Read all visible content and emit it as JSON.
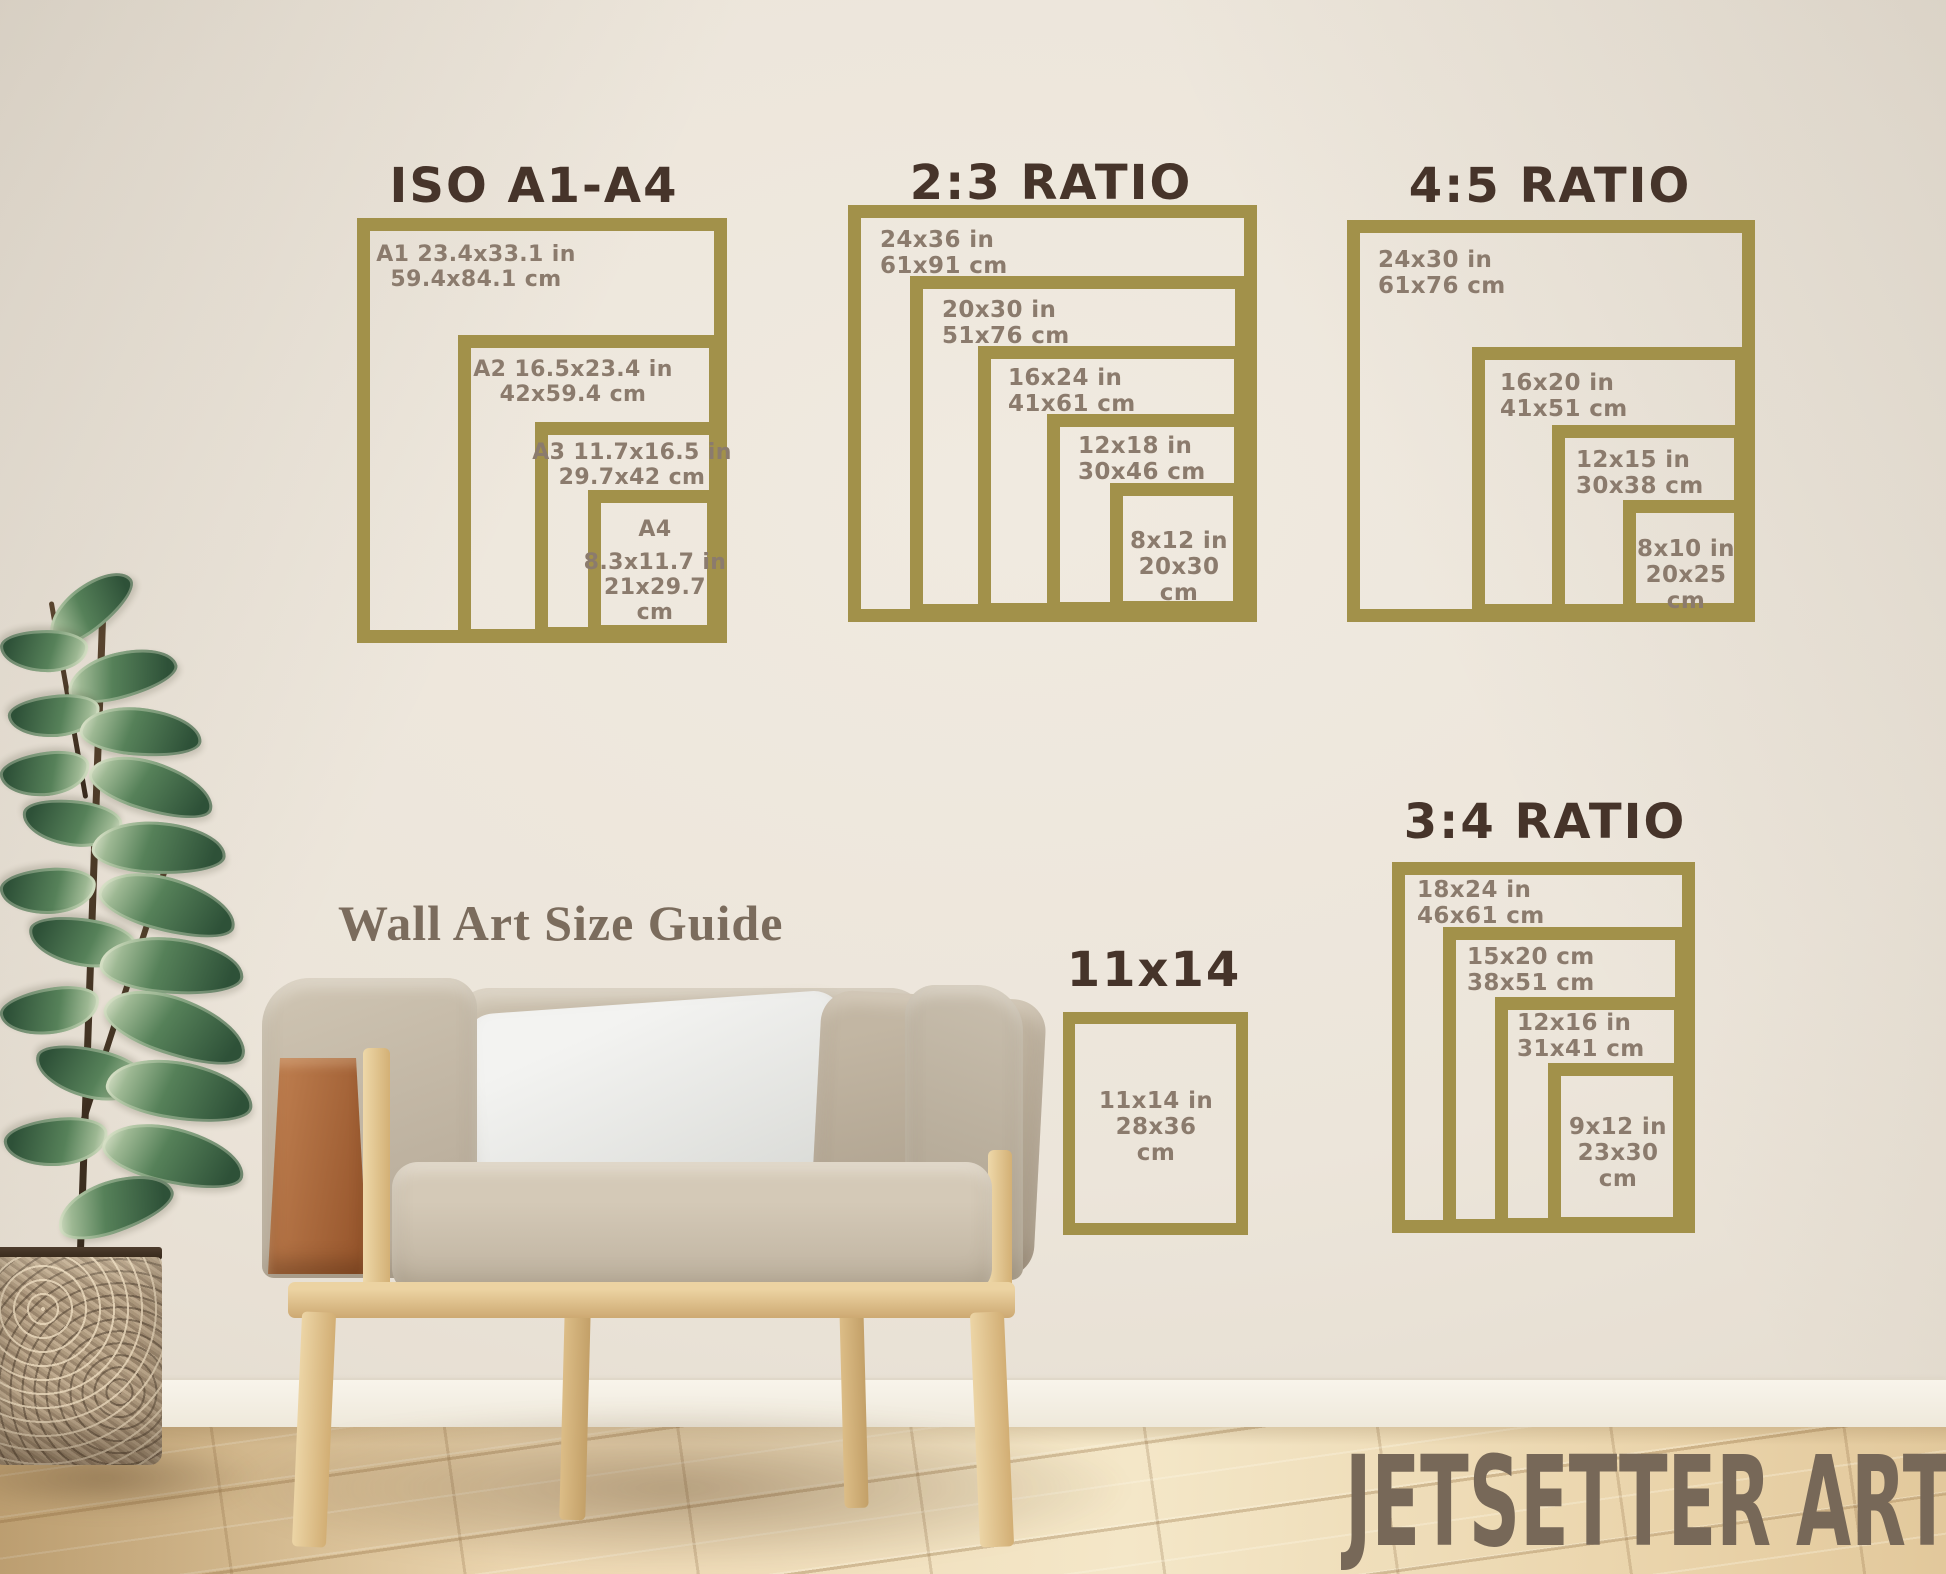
{
  "page": {
    "caption": "Wall Art Size Guide",
    "watermark": "JETSETTER ARTS"
  },
  "palette": {
    "gold": "#a2914a",
    "heading": "#46342a",
    "label": "#8b7b6d",
    "caption": "#7b6c5d",
    "watermark": "#776858"
  },
  "sections": {
    "iso": {
      "title": "ISO A1-A4",
      "f1": {
        "l1": "A1 23.4x33.1 in",
        "l2": "59.4x84.1 cm"
      },
      "f2": {
        "l1": "A2 16.5x23.4 in",
        "l2": "42x59.4 cm"
      },
      "f3": {
        "l1": "A3 11.7x16.5 in",
        "l2": "29.7x42 cm"
      },
      "f4": {
        "l1": "A4",
        "l2": "8.3x11.7 in",
        "l3": "21x29.7",
        "l4": "cm"
      }
    },
    "ratio23": {
      "title": "2:3 RATIO",
      "f1": {
        "l1": "24x36 in",
        "l2": "61x91 cm"
      },
      "f2": {
        "l1": "20x30 in",
        "l2": "51x76 cm"
      },
      "f3": {
        "l1": "16x24 in",
        "l2": "41x61 cm"
      },
      "f4": {
        "l1": "12x18 in",
        "l2": "30x46 cm"
      },
      "f5": {
        "l1": "8x12 in",
        "l2": "20x30",
        "l3": "cm"
      }
    },
    "ratio45": {
      "title": "4:5 RATIO",
      "f1": {
        "l1": "24x30 in",
        "l2": "61x76 cm"
      },
      "f2": {
        "l1": "16x20 in",
        "l2": "41x51 cm"
      },
      "f3": {
        "l1": "12x15 in",
        "l2": "30x38 cm"
      },
      "f4": {
        "l1": "8x10 in",
        "l2": "20x25",
        "l3": "cm"
      }
    },
    "ratio34": {
      "title": "3:4 RATIO",
      "f1": {
        "l1": "18x24 in",
        "l2": "46x61 cm"
      },
      "f2": {
        "l1": "15x20 cm",
        "l2": "38x51 cm"
      },
      "f3": {
        "l1": "12x16 in",
        "l2": "31x41 cm"
      },
      "f4": {
        "l1": "9x12 in",
        "l2": "23x30",
        "l3": "cm"
      }
    },
    "single11x14": {
      "title": "11x14",
      "f1": {
        "l1": "11x14 in",
        "l2": "28x36",
        "l3": "cm"
      }
    }
  }
}
